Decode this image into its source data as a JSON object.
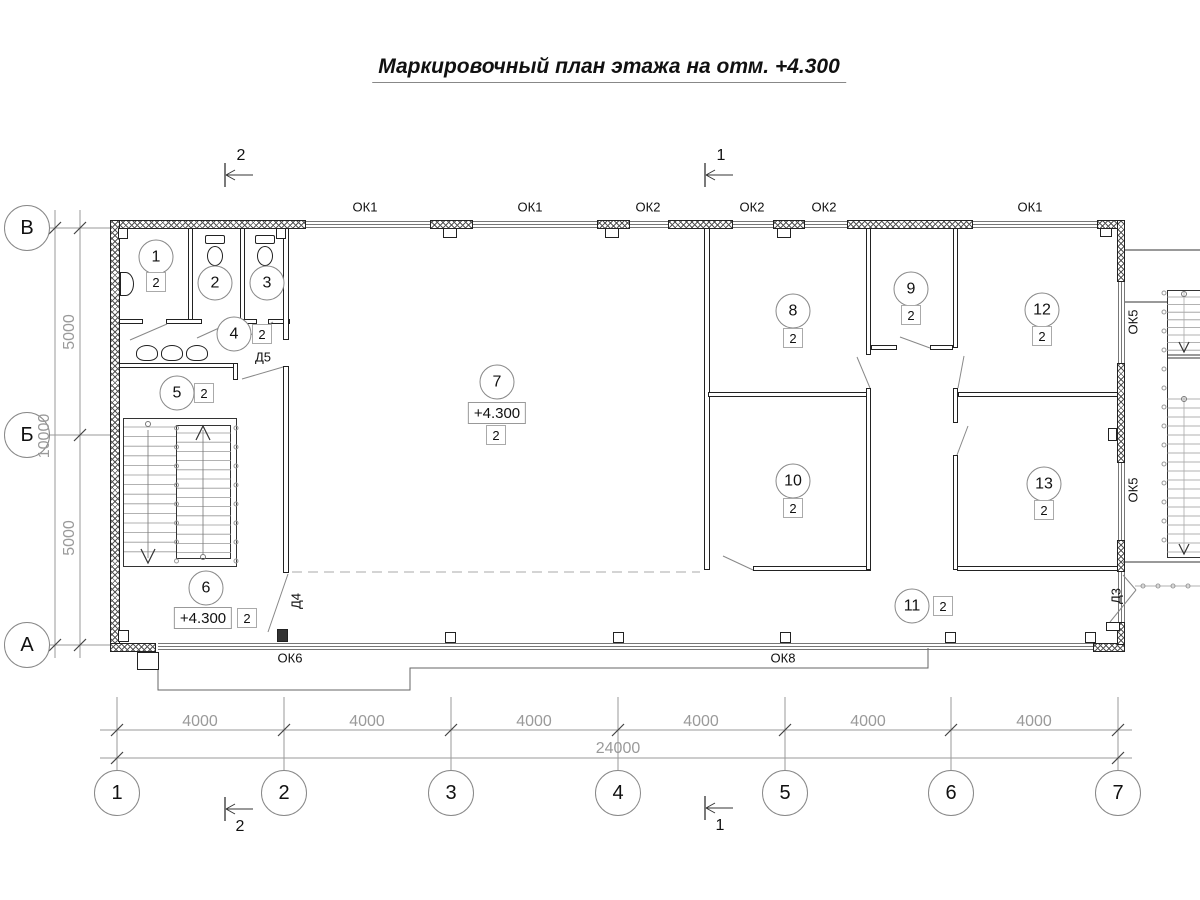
{
  "title": "Маркировочный план этажа на отм. +4.300",
  "colors": {
    "wall": "#222222",
    "dim": "#9a9a9a",
    "accent": "#555555"
  },
  "axes": {
    "columns": [
      {
        "label": "1",
        "x": 117
      },
      {
        "label": "2",
        "x": 284
      },
      {
        "label": "3",
        "x": 451
      },
      {
        "label": "4",
        "x": 618
      },
      {
        "label": "5",
        "x": 785
      },
      {
        "label": "6",
        "x": 951
      },
      {
        "label": "7",
        "x": 1118
      }
    ],
    "rows": [
      {
        "label": "В",
        "y": 228
      },
      {
        "label": "Б",
        "y": 435
      },
      {
        "label": "А",
        "y": 645
      }
    ]
  },
  "dimensions": {
    "bottom_segments": [
      {
        "text": "4000",
        "x": 200
      },
      {
        "text": "4000",
        "x": 367
      },
      {
        "text": "4000",
        "x": 534
      },
      {
        "text": "4000",
        "x": 701
      },
      {
        "text": "4000",
        "x": 868
      },
      {
        "text": "4000",
        "x": 1034
      }
    ],
    "bottom_total": {
      "text": "24000",
      "x": 618,
      "y": 749
    },
    "left_segments": [
      {
        "text": "5000",
        "y": 332
      },
      {
        "text": "5000",
        "y": 538
      }
    ],
    "left_total": {
      "text": "10000",
      "x": 45,
      "y": 436
    }
  },
  "windows": {
    "top": [
      {
        "label": "ОК1",
        "x": 365
      },
      {
        "label": "ОК1",
        "x": 530
      },
      {
        "label": "ОК2",
        "x": 648
      },
      {
        "label": "ОК2",
        "x": 752
      },
      {
        "label": "ОК2",
        "x": 824
      },
      {
        "label": "ОК1",
        "x": 1030
      }
    ],
    "right": [
      {
        "label": "ОК5",
        "y": 322
      },
      {
        "label": "ОК5",
        "y": 490
      }
    ],
    "bottom": [
      {
        "label": "ОК6",
        "x": 290,
        "y": 658
      },
      {
        "label": "ОК8",
        "x": 783,
        "y": 658
      }
    ]
  },
  "doors": [
    {
      "label": "Д5",
      "x": 263,
      "y": 357,
      "rot": false
    },
    {
      "label": "Д4",
      "x": 296,
      "y": 601,
      "rot": true
    },
    {
      "label": "Д3",
      "x": 1116,
      "y": 596,
      "rot": true
    }
  ],
  "sections": [
    {
      "label": "2",
      "x": 241,
      "y": 156
    },
    {
      "label": "1",
      "x": 721,
      "y": 156
    },
    {
      "label": "2",
      "x": 240,
      "y": 827
    },
    {
      "label": "1",
      "x": 720,
      "y": 826
    }
  ],
  "rooms": [
    {
      "num": "1",
      "cx": 156,
      "cy": 257,
      "fin": {
        "x": 156,
        "y": 282
      }
    },
    {
      "num": "2",
      "cx": 215,
      "cy": 283
    },
    {
      "num": "3",
      "cx": 267,
      "cy": 283
    },
    {
      "num": "4",
      "cx": 234,
      "cy": 334,
      "fin": {
        "x": 262,
        "y": 334
      }
    },
    {
      "num": "5",
      "cx": 177,
      "cy": 393,
      "fin": {
        "x": 204,
        "y": 393
      }
    },
    {
      "num": "6",
      "cx": 206,
      "cy": 588,
      "fin": {
        "x": 247,
        "y": 618
      },
      "elev": {
        "text": "+4.300",
        "x": 203,
        "y": 618
      }
    },
    {
      "num": "7",
      "cx": 497,
      "cy": 382,
      "fin": {
        "x": 496,
        "y": 435
      },
      "elev": {
        "text": "+4.300",
        "x": 497,
        "y": 413
      }
    },
    {
      "num": "8",
      "cx": 793,
      "cy": 311,
      "fin": {
        "x": 793,
        "y": 338
      }
    },
    {
      "num": "9",
      "cx": 911,
      "cy": 289,
      "fin": {
        "x": 911,
        "y": 315
      }
    },
    {
      "num": "10",
      "cx": 793,
      "cy": 481,
      "fin": {
        "x": 793,
        "y": 508
      }
    },
    {
      "num": "11",
      "cx": 912,
      "cy": 606,
      "fin": {
        "x": 943,
        "y": 606
      }
    },
    {
      "num": "12",
      "cx": 1042,
      "cy": 310,
      "fin": {
        "x": 1042,
        "y": 336
      }
    },
    {
      "num": "13",
      "cx": 1044,
      "cy": 484,
      "fin": {
        "x": 1044,
        "y": 510
      }
    }
  ]
}
